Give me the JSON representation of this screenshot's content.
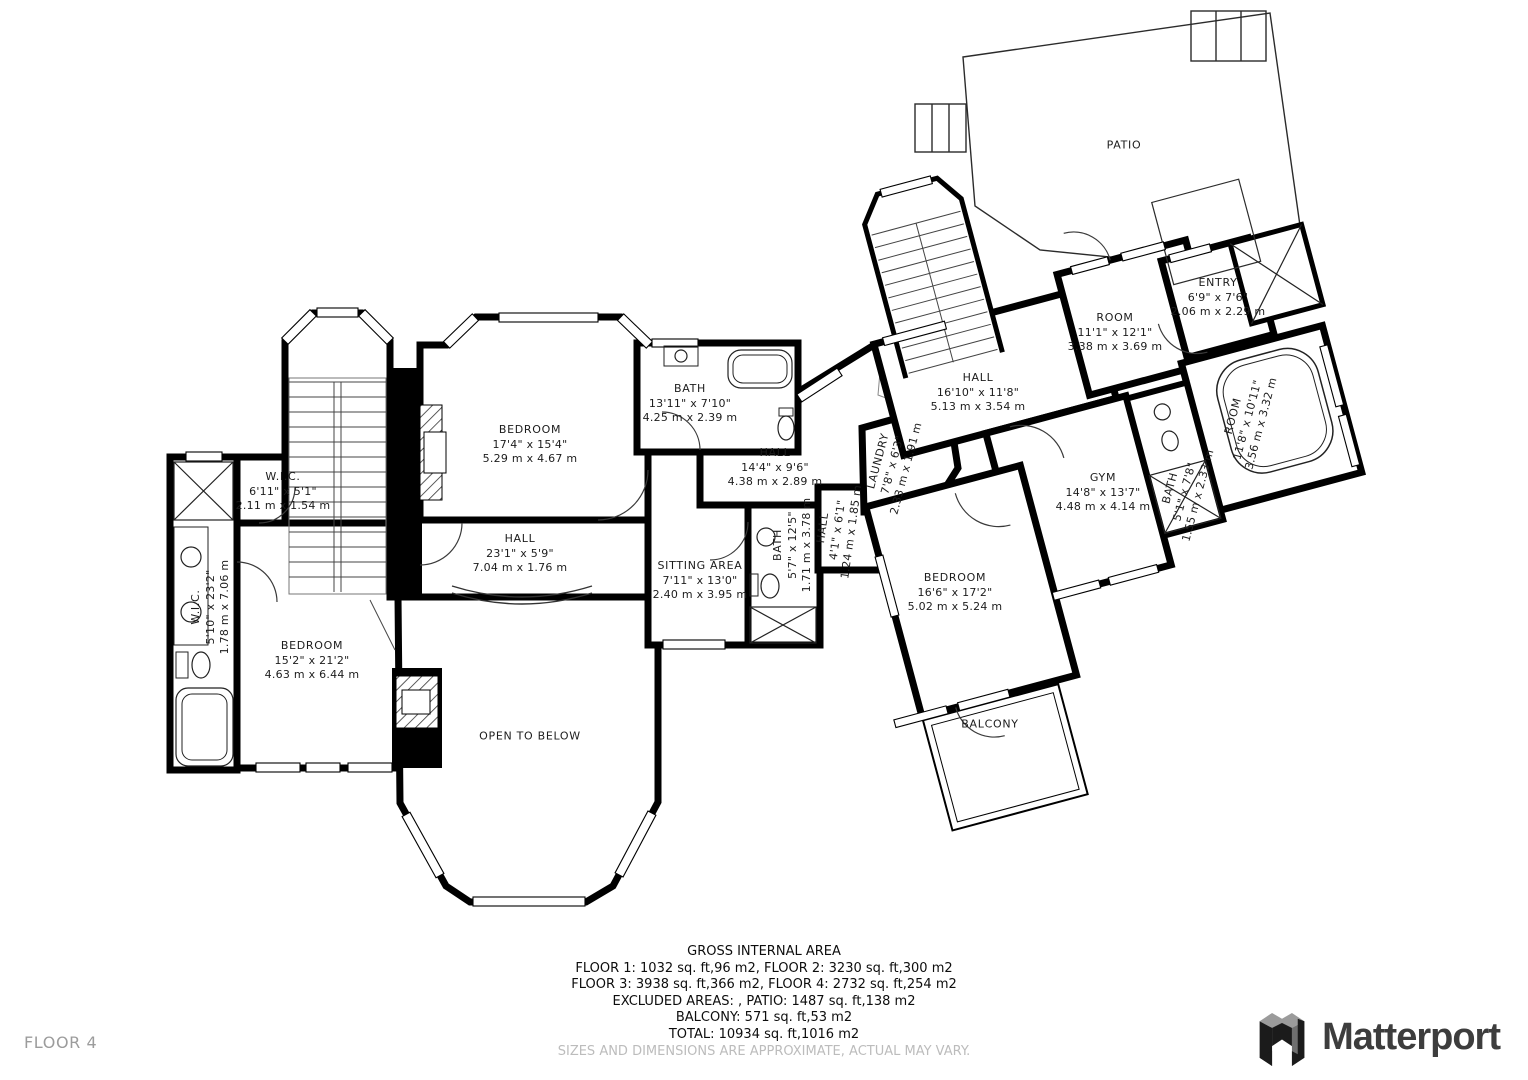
{
  "floor_plan": {
    "floor_label": "FLOOR 4",
    "rooms": [
      {
        "id": "patio",
        "name": "PATIO",
        "dims_ft": "",
        "dims_m": "",
        "x": 1124,
        "y": 146,
        "rot": 0
      },
      {
        "id": "wic-top",
        "name": "W.I.C.",
        "dims_ft": "6'11\" x 5'1\"",
        "dims_m": "2.11 m x 1.54 m",
        "x": 283,
        "y": 492,
        "rot": 0
      },
      {
        "id": "wic-left",
        "name": "W.I.C.",
        "dims_ft": "5'10\" x 23'2\"",
        "dims_m": "1.78 m x 7.06 m",
        "x": 211,
        "y": 607,
        "rot": -90
      },
      {
        "id": "bedroom-left",
        "name": "BEDROOM",
        "dims_ft": "15'2\" x 21'2\"",
        "dims_m": "4.63 m x 6.44 m",
        "x": 312,
        "y": 661,
        "rot": 0
      },
      {
        "id": "bedroom-top",
        "name": "BEDROOM",
        "dims_ft": "17'4\" x 15'4\"",
        "dims_m": "5.29 m x 4.67 m",
        "x": 530,
        "y": 445,
        "rot": 0
      },
      {
        "id": "bath-top",
        "name": "BATH",
        "dims_ft": "13'11\" x 7'10\"",
        "dims_m": "4.25 m x 2.39 m",
        "x": 690,
        "y": 404,
        "rot": 0
      },
      {
        "id": "hall-main",
        "name": "HALL",
        "dims_ft": "23'1\" x 5'9\"",
        "dims_m": "7.04 m x 1.76 m",
        "x": 520,
        "y": 554,
        "rot": 0
      },
      {
        "id": "open-below",
        "name": "OPEN TO BELOW",
        "dims_ft": "",
        "dims_m": "",
        "x": 530,
        "y": 737,
        "rot": 0
      },
      {
        "id": "sitting-area",
        "name": "SITTING AREA",
        "dims_ft": "7'11\" x 13'0\"",
        "dims_m": "2.40 m x 3.95 m",
        "x": 700,
        "y": 581,
        "rot": 0
      },
      {
        "id": "bath-mid",
        "name": "BATH",
        "dims_ft": "5'7\" x 12'5\"",
        "dims_m": "1.71 m x 3.78 m",
        "x": 793,
        "y": 545,
        "rot": -90
      },
      {
        "id": "hall-14",
        "name": "HALL",
        "dims_ft": "14'4\" x 9'6\"",
        "dims_m": "4.38 m x 2.89 m",
        "x": 775,
        "y": 468,
        "rot": 0
      },
      {
        "id": "hall-small",
        "name": "HALL",
        "dims_ft": "4'1\" x 6'1\"",
        "dims_m": "1.24 m x 1.85 m",
        "x": 838,
        "y": 530,
        "rot": -82
      },
      {
        "id": "laundry",
        "name": "LAUNDRY",
        "dims_ft": "7'8\" x 6'3\"",
        "dims_m": "2.33 m x 1.91 m",
        "x": 893,
        "y": 465,
        "rot": -75
      },
      {
        "id": "hall-right",
        "name": "HALL",
        "dims_ft": "16'10\" x 11'8\"",
        "dims_m": "5.13 m x 3.54 m",
        "x": 978,
        "y": 393,
        "rot": 0
      },
      {
        "id": "room-center",
        "name": "ROOM",
        "dims_ft": "11'1\" x 12'1\"",
        "dims_m": "3.38 m x 3.69 m",
        "x": 1115,
        "y": 333,
        "rot": 0
      },
      {
        "id": "entry",
        "name": "ENTRY",
        "dims_ft": "6'9\" x 7'6\"",
        "dims_m": "2.06 m x 2.29 m",
        "x": 1218,
        "y": 298,
        "rot": 0
      },
      {
        "id": "gym",
        "name": "GYM",
        "dims_ft": "14'8\" x 13'7\"",
        "dims_m": "4.48 m x 4.14 m",
        "x": 1103,
        "y": 493,
        "rot": 0
      },
      {
        "id": "bath-right",
        "name": "BATH",
        "dims_ft": "5'1\" x 7'8\"",
        "dims_m": "1.55 m x 2.33 m",
        "x": 1185,
        "y": 492,
        "rot": -75
      },
      {
        "id": "room-right",
        "name": "ROOM",
        "dims_ft": "11'8\" x 10'11\"",
        "dims_m": "3.56 m x 3.32 m",
        "x": 1248,
        "y": 420,
        "rot": -75
      },
      {
        "id": "bedroom-right",
        "name": "BEDROOM",
        "dims_ft": "16'6\" x 17'2\"",
        "dims_m": "5.02 m x 5.24 m",
        "x": 955,
        "y": 593,
        "rot": 0
      },
      {
        "id": "balcony",
        "name": "BALCONY",
        "dims_ft": "",
        "dims_m": "",
        "x": 990,
        "y": 725,
        "rot": 0
      }
    ]
  },
  "footer": {
    "title": "GROSS INTERNAL AREA",
    "lines": [
      "FLOOR 1: 1032 sq. ft,96 m2, FLOOR 2: 3230 sq. ft,300 m2",
      "FLOOR 3: 3938 sq. ft,366 m2, FLOOR 4: 2732 sq. ft,254 m2",
      "EXCLUDED AREAS: , PATIO: 1487 sq. ft,138 m2",
      "BALCONY: 571 sq. ft,53 m2",
      "TOTAL: 10934 sq. ft,1016 m2"
    ],
    "disclaimer": "SIZES AND DIMENSIONS ARE APPROXIMATE, ACTUAL MAY VARY."
  },
  "brand": {
    "name": "Matterport"
  },
  "colors": {
    "wall": "#000000",
    "label": "#1c1c1c",
    "muted": "#9c9c9c",
    "logo_text": "#3d3d3d"
  }
}
